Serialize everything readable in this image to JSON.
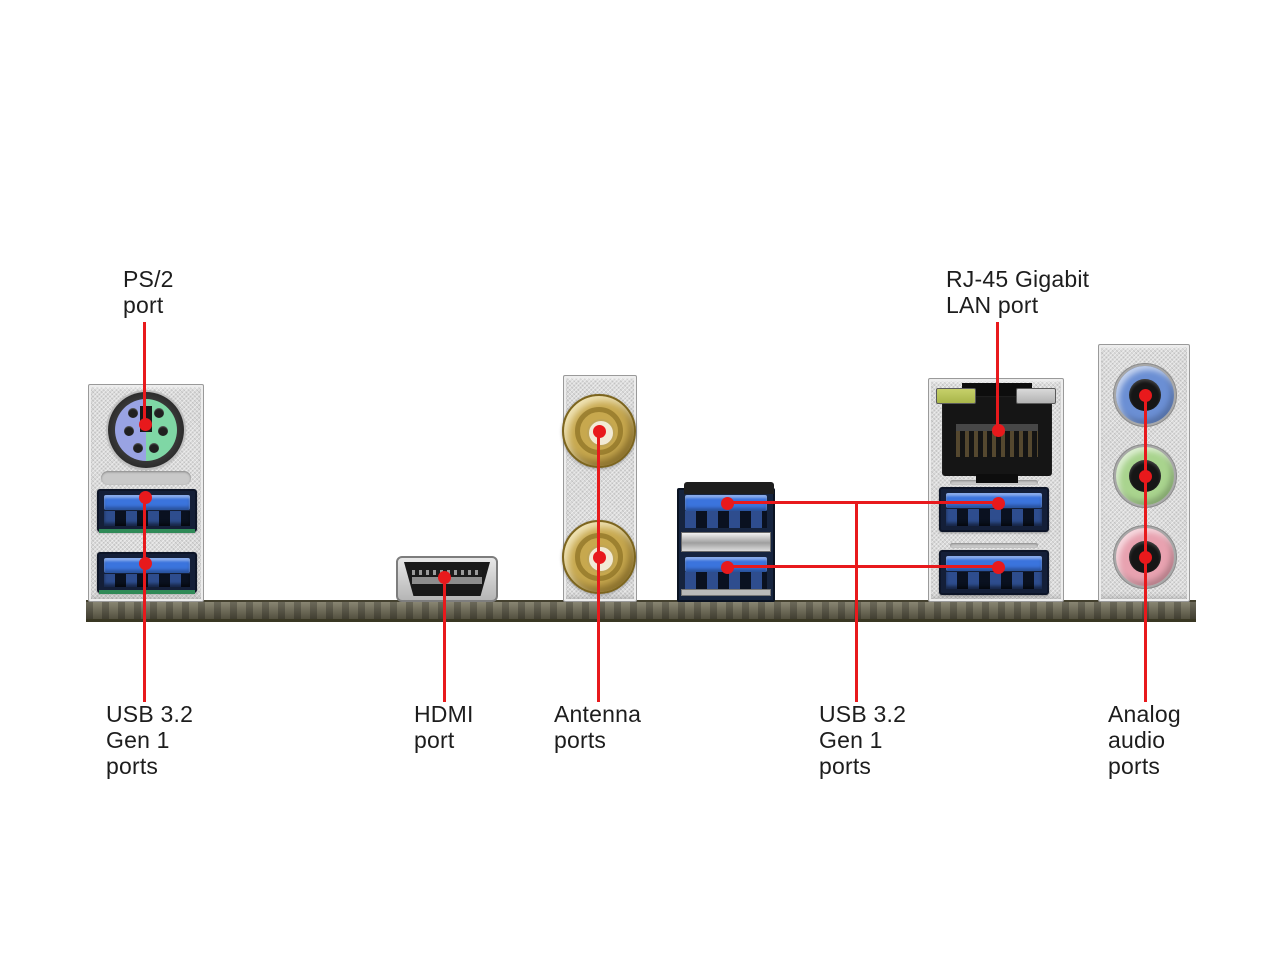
{
  "annotations": {
    "labels": {
      "ps2": "PS/2\nport",
      "usb_left": "USB 3.2\nGen 1\nports",
      "hdmi": "HDMI\nport",
      "antenna": "Antenna\nports",
      "lan": "RJ-45 Gigabit\nLAN port",
      "usb_mid": "USB 3.2\nGen 1\nports",
      "audio": "Analog\naudio\nports"
    }
  },
  "ports": [
    {
      "name": "PS/2 port",
      "count": 1
    },
    {
      "name": "USB 3.2 Gen 1 ports (left block)",
      "count": 2
    },
    {
      "name": "HDMI port",
      "count": 1
    },
    {
      "name": "Antenna ports",
      "count": 2
    },
    {
      "name": "RJ-45 Gigabit LAN port",
      "count": 1
    },
    {
      "name": "USB 3.2 Gen 1 ports (middle and right blocks)",
      "count": 4
    },
    {
      "name": "Analog audio ports",
      "count": 3
    }
  ],
  "colors": {
    "annotation_red": "#e8191c",
    "usb_blue": "#3b74dd",
    "ps2_purple": "#99a3e3",
    "ps2_green": "#7fd7a5",
    "antenna_gold": "#c7a84e",
    "audio_blue": "#6b8fd4",
    "audio_green": "#a9d48e",
    "audio_pink": "#e8a2b0",
    "lan_led_green": "#a9b64a",
    "bracket_silver": "#dadada",
    "pcb_olive": "#6f6b54"
  }
}
